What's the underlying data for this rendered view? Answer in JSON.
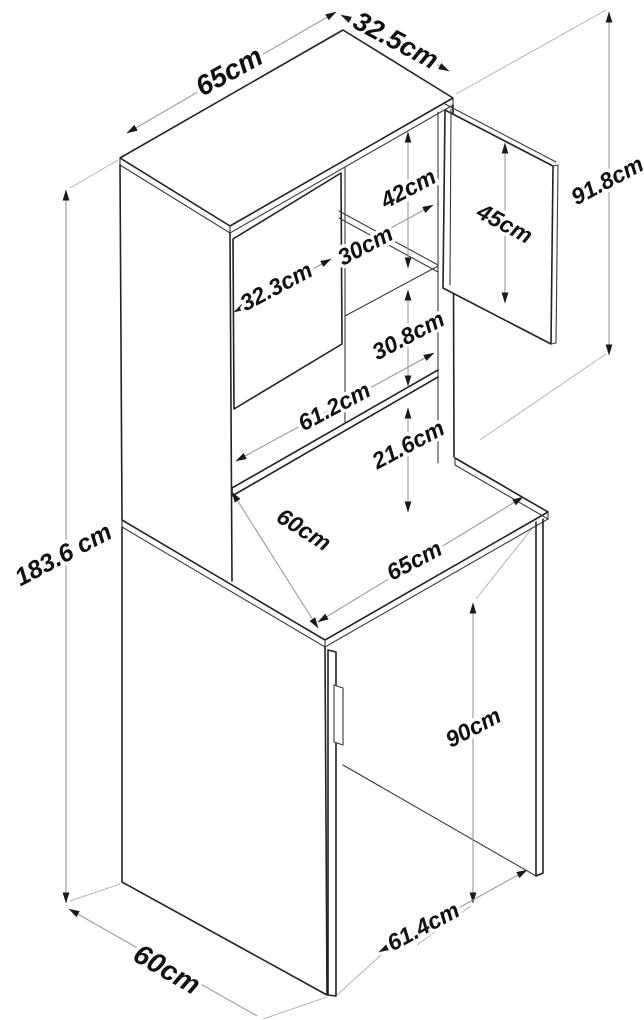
{
  "diagram": {
    "type": "furniture-dimension-drawing",
    "subject": "tall cabinet with hutch, countertop and open appliance bay",
    "unit": "cm",
    "labels": {
      "top_width": "65cm",
      "top_depth": "32.5cm",
      "hutch_height": "91.8cm",
      "upper_door_height": "45cm",
      "upper_opening_height": "42cm",
      "upper_opening_width": "30cm",
      "left_door_width": "32.3cm",
      "middle_opening_height": "30.8cm",
      "shelf_width": "61.2cm",
      "lower_gap_height": "21.6cm",
      "counter_depth": "60cm",
      "counter_width": "65cm",
      "total_height": "183.6 cm",
      "base_opening_height": "90cm",
      "base_opening_width": "61.4cm",
      "base_depth": "60cm"
    },
    "colors": {
      "object_line": "#222222",
      "dimension_line": "#9b9b9b",
      "extension_line": "#b5b5b5",
      "arrow": "#1a1a1a",
      "text": "#111111",
      "background": "#ffffff"
    }
  }
}
